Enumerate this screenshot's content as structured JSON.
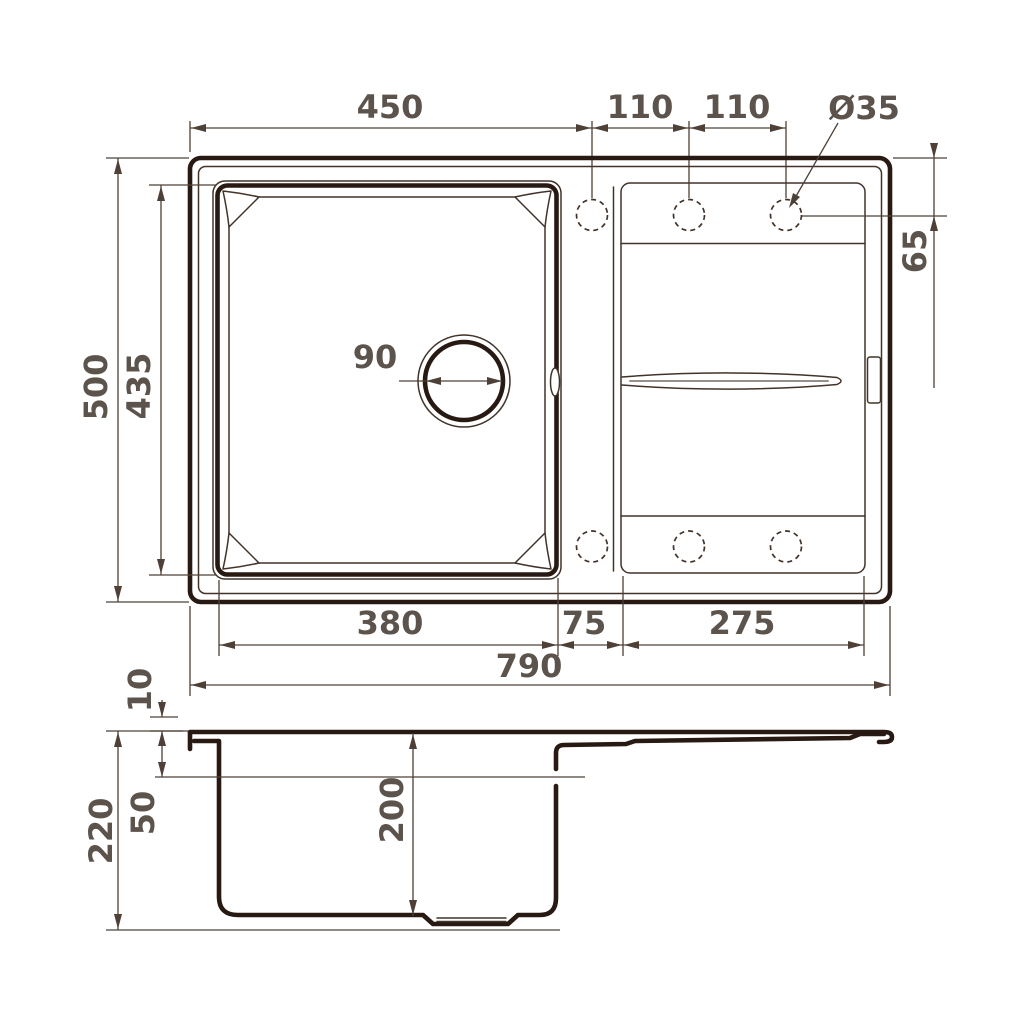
{
  "drawing": {
    "colors": {
      "line": "#281a12",
      "line_thin": "#41332a",
      "dim_line": "#4e4037",
      "text": "#5c544c",
      "background": "#ffffff"
    },
    "top_view": {
      "dim_450": "450",
      "dim_110_left": "110",
      "dim_110_right": "110",
      "dim_hole_diameter": "Ø35",
      "dim_500": "500",
      "dim_435": "435",
      "dim_65": "65",
      "dim_drain_90": "90",
      "dim_380": "380",
      "dim_75": "75",
      "dim_275": "275",
      "dim_790": "790"
    },
    "side_view": {
      "dim_10": "10",
      "dim_50": "50",
      "dim_220": "220",
      "dim_200": "200"
    }
  }
}
